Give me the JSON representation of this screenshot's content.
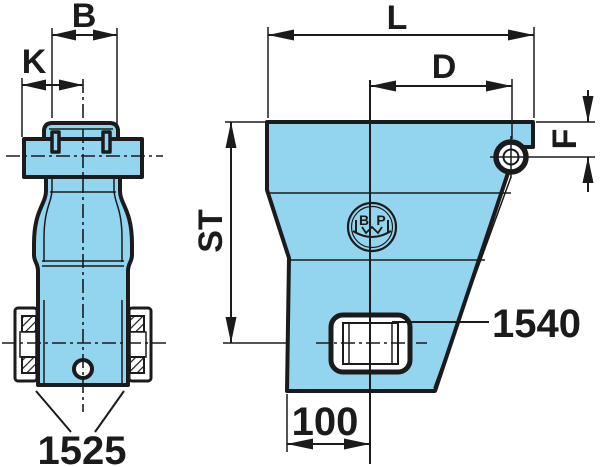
{
  "drawing": {
    "type": "technical-drawing",
    "front_view": {
      "dim_width_top": "B",
      "dim_offset_left": "K",
      "part_number_bushes": "1525"
    },
    "side_view": {
      "dim_length": "L",
      "dim_hole_distance": "D",
      "dim_hole_drop": "F",
      "dim_height": "ST",
      "dim_base": "100",
      "part_number_bushing": "1540"
    },
    "logo": {
      "name": "BPW",
      "letter_b": "B",
      "letter_p": "P"
    },
    "colors": {
      "part_fill": "#93d4ee",
      "line": "#1b1b1b",
      "background": "#ffffff"
    }
  }
}
